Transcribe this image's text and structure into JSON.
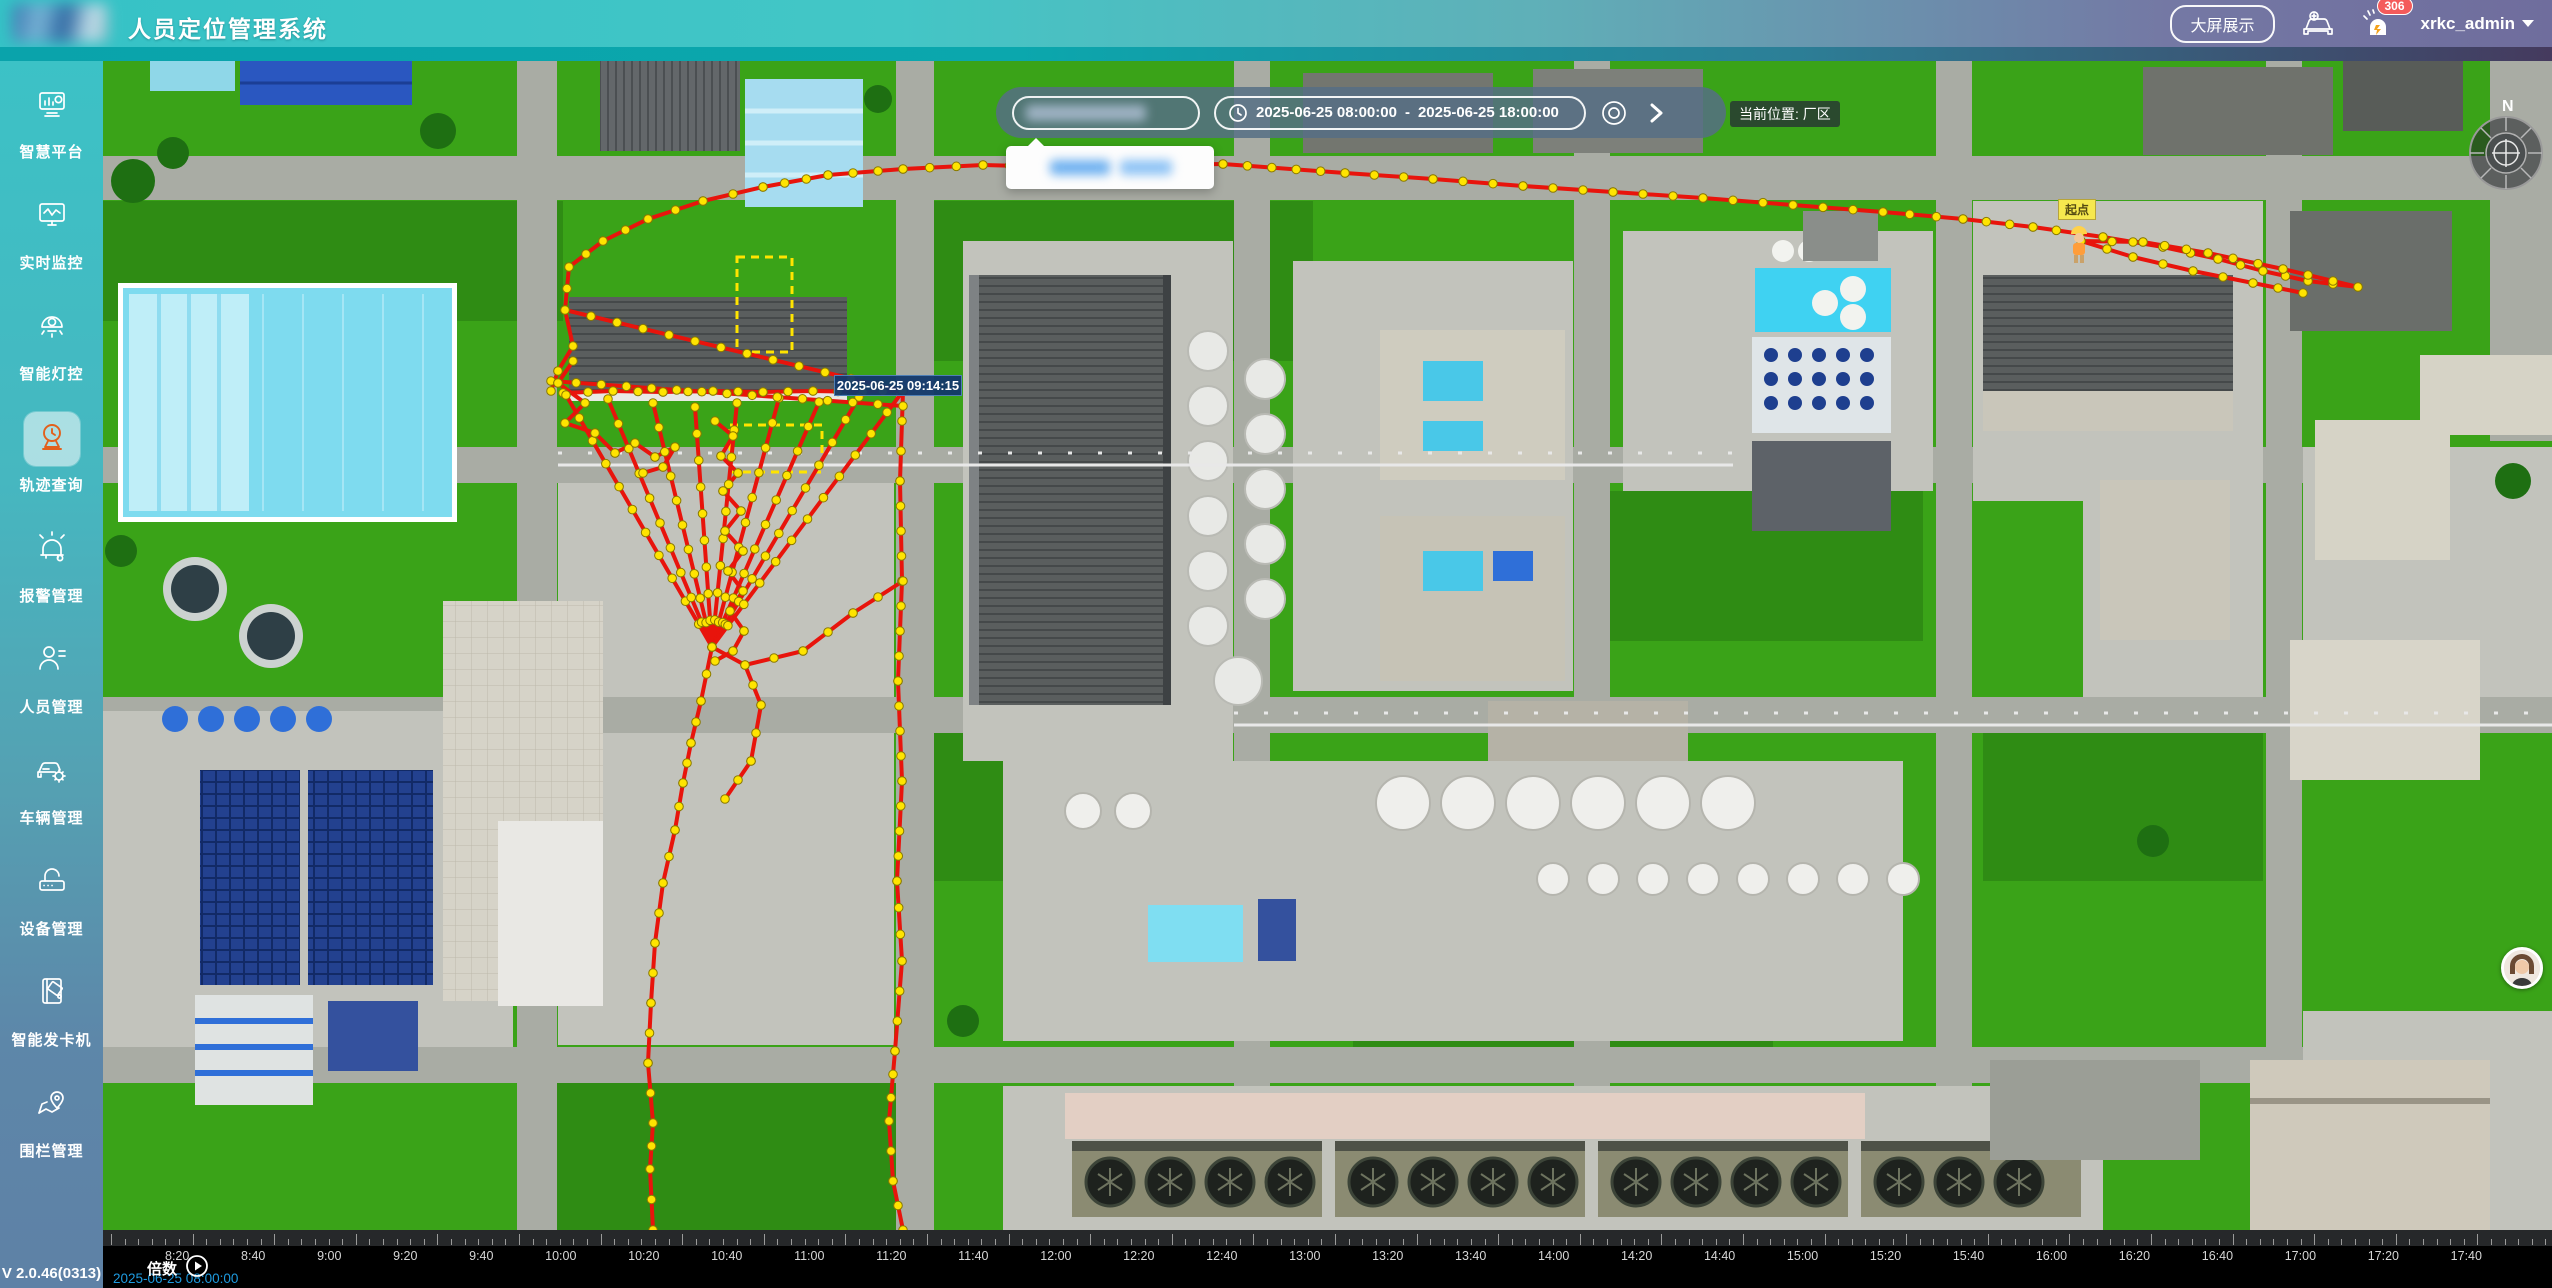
{
  "header": {
    "title": "人员定位管理系统",
    "big_screen_button": "大屏展示",
    "badge_count": "306",
    "username": "xrkc_admin"
  },
  "sidebar": {
    "items": [
      {
        "label": "智慧平台"
      },
      {
        "label": "实时监控"
      },
      {
        "label": "智能灯控"
      },
      {
        "label": "轨迹查询"
      },
      {
        "label": "报警管理"
      },
      {
        "label": "人员管理"
      },
      {
        "label": "车辆管理"
      },
      {
        "label": "设备管理"
      },
      {
        "label": "智能发卡机"
      },
      {
        "label": "围栏管理"
      }
    ],
    "version": "V 2.0.46(0313)"
  },
  "toolbar": {
    "date_start": "2025-06-25 08:00:00",
    "date_separator": "-",
    "date_end": "2025-06-25 18:00:00",
    "current_location_label": "当前位置: 厂区"
  },
  "map": {
    "tooltip_time": "2025-06-25 09:14:15",
    "start_point_label": "起点",
    "compass_north": "N"
  },
  "timeline": {
    "speed_label": "倍数",
    "current_time": "2025-06-25 08:00:00",
    "tick_labels": [
      "8:20",
      "8:40",
      "9:00",
      "9:20",
      "9:40",
      "10:00",
      "10:20",
      "10:40",
      "11:00",
      "11:20",
      "11:40",
      "12:00",
      "12:20",
      "12:40",
      "13:00",
      "13:20",
      "13:40",
      "14:00",
      "14:20",
      "14:40",
      "15:00",
      "15:20",
      "15:40",
      "16:00",
      "16:20",
      "16:40",
      "17:00",
      "17:20",
      "17:40"
    ]
  },
  "colors": {
    "accent_teal": "#3cc2c6",
    "accent_purple": "#6f6d9d",
    "active_icon_orange": "#e2601c",
    "trajectory_red": "#e8140c",
    "trajectory_dot_yellow": "#ffe400",
    "badge_red": "#f45b5b",
    "timeline_time_blue": "#1e9be0",
    "start_label_yellow": "#f6e84e"
  },
  "trajectory": {
    "dot_spacing": 26,
    "lines": [
      {
        "pts": [
          [
            462,
            249
          ],
          [
            466,
            206
          ],
          [
            500,
            180
          ],
          [
            545,
            158
          ],
          [
            600,
            140
          ],
          [
            660,
            126
          ],
          [
            725,
            114
          ],
          [
            800,
            108
          ],
          [
            880,
            104
          ],
          [
            960,
            106
          ],
          [
            1040,
            104
          ],
          [
            1120,
            103
          ],
          [
            1242,
            112
          ],
          [
            1330,
            118
          ],
          [
            1420,
            125
          ],
          [
            1510,
            131
          ],
          [
            1600,
            137
          ],
          [
            1690,
            144
          ],
          [
            1780,
            151
          ],
          [
            1860,
            158
          ],
          [
            1930,
            166
          ],
          [
            2000,
            176
          ],
          [
            2060,
            186
          ],
          [
            2115,
            198
          ],
          [
            2160,
            210
          ],
          [
            2205,
            220
          ],
          [
            2255,
            226
          ]
        ]
      },
      {
        "pts": [
          [
            2255,
            226
          ],
          [
            2180,
            208
          ],
          [
            2105,
            192
          ],
          [
            2040,
            181
          ],
          [
            1978,
            180
          ],
          [
            2030,
            196
          ],
          [
            2090,
            210
          ],
          [
            2150,
            222
          ],
          [
            2200,
            232
          ]
        ]
      },
      {
        "pts": [
          [
            800,
            330
          ],
          [
            797,
            420
          ],
          [
            799,
            520
          ],
          [
            795,
            620
          ],
          [
            799,
            720
          ],
          [
            794,
            820
          ],
          [
            799,
            900
          ],
          [
            792,
            990
          ],
          [
            786,
            1060
          ],
          [
            790,
            1120
          ],
          [
            800,
            1169
          ]
        ]
      },
      {
        "pts": [
          [
            460,
            332
          ],
          [
            510,
            330
          ],
          [
            560,
            331
          ],
          [
            610,
            330
          ],
          [
            660,
            331
          ],
          [
            710,
            330
          ],
          [
            760,
            331
          ],
          [
            800,
            330
          ]
        ]
      },
      {
        "pts": [
          [
            609,
            586
          ],
          [
            463,
            334
          ]
        ]
      },
      {
        "pts": [
          [
            609,
            586
          ],
          [
            505,
            338
          ]
        ]
      },
      {
        "pts": [
          [
            609,
            586
          ],
          [
            550,
            342
          ]
        ]
      },
      {
        "pts": [
          [
            609,
            586
          ],
          [
            592,
            346
          ]
        ]
      },
      {
        "pts": [
          [
            609,
            586
          ],
          [
            634,
            342
          ]
        ]
      },
      {
        "pts": [
          [
            609,
            586
          ],
          [
            676,
            337
          ]
        ]
      },
      {
        "pts": [
          [
            609,
            586
          ],
          [
            716,
            341
          ]
        ]
      },
      {
        "pts": [
          [
            609,
            586
          ],
          [
            756,
            336
          ]
        ]
      },
      {
        "pts": [
          [
            609,
            586
          ],
          [
            800,
            330
          ]
        ]
      },
      {
        "pts": [
          [
            462,
            249
          ],
          [
            800,
            330
          ]
        ]
      },
      {
        "pts": [
          [
            448,
            320
          ],
          [
            800,
            345
          ]
        ]
      },
      {
        "pts": [
          [
            462,
            249
          ],
          [
            470,
            285
          ],
          [
            455,
            310
          ],
          [
            448,
            330
          ]
        ]
      },
      {
        "pts": [
          [
            612,
            360
          ],
          [
            630,
            375
          ],
          [
            618,
            395
          ],
          [
            635,
            412
          ],
          [
            620,
            430
          ],
          [
            638,
            450
          ],
          [
            622,
            470
          ],
          [
            640,
            490
          ],
          [
            625,
            510
          ],
          [
            640,
            530
          ],
          [
            627,
            550
          ],
          [
            641,
            570
          ],
          [
            630,
            590
          ],
          [
            612,
            600
          ]
        ]
      },
      {
        "pts": [
          [
            470,
            300
          ],
          [
            455,
            322
          ],
          [
            482,
            342
          ],
          [
            462,
            362
          ],
          [
            492,
            372
          ],
          [
            512,
            392
          ],
          [
            532,
            382
          ],
          [
            552,
            396
          ],
          [
            572,
            386
          ],
          [
            560,
            406
          ],
          [
            540,
            412
          ]
        ]
      },
      {
        "pts": [
          [
            609,
            586
          ],
          [
            598,
            640
          ],
          [
            588,
            682
          ],
          [
            580,
            722
          ],
          [
            572,
            769
          ],
          [
            560,
            822
          ],
          [
            552,
            882
          ],
          [
            548,
            942
          ],
          [
            545,
            1002
          ],
          [
            550,
            1062
          ],
          [
            547,
            1108
          ],
          [
            550,
            1169
          ]
        ]
      },
      {
        "pts": [
          [
            642,
            604
          ],
          [
            700,
            590
          ],
          [
            750,
            552
          ],
          [
            800,
            520
          ]
        ]
      },
      {
        "pts": [
          [
            609,
            586
          ],
          [
            642,
            604
          ],
          [
            658,
            644
          ],
          [
            648,
            700
          ],
          [
            622,
            738
          ]
        ]
      }
    ]
  }
}
